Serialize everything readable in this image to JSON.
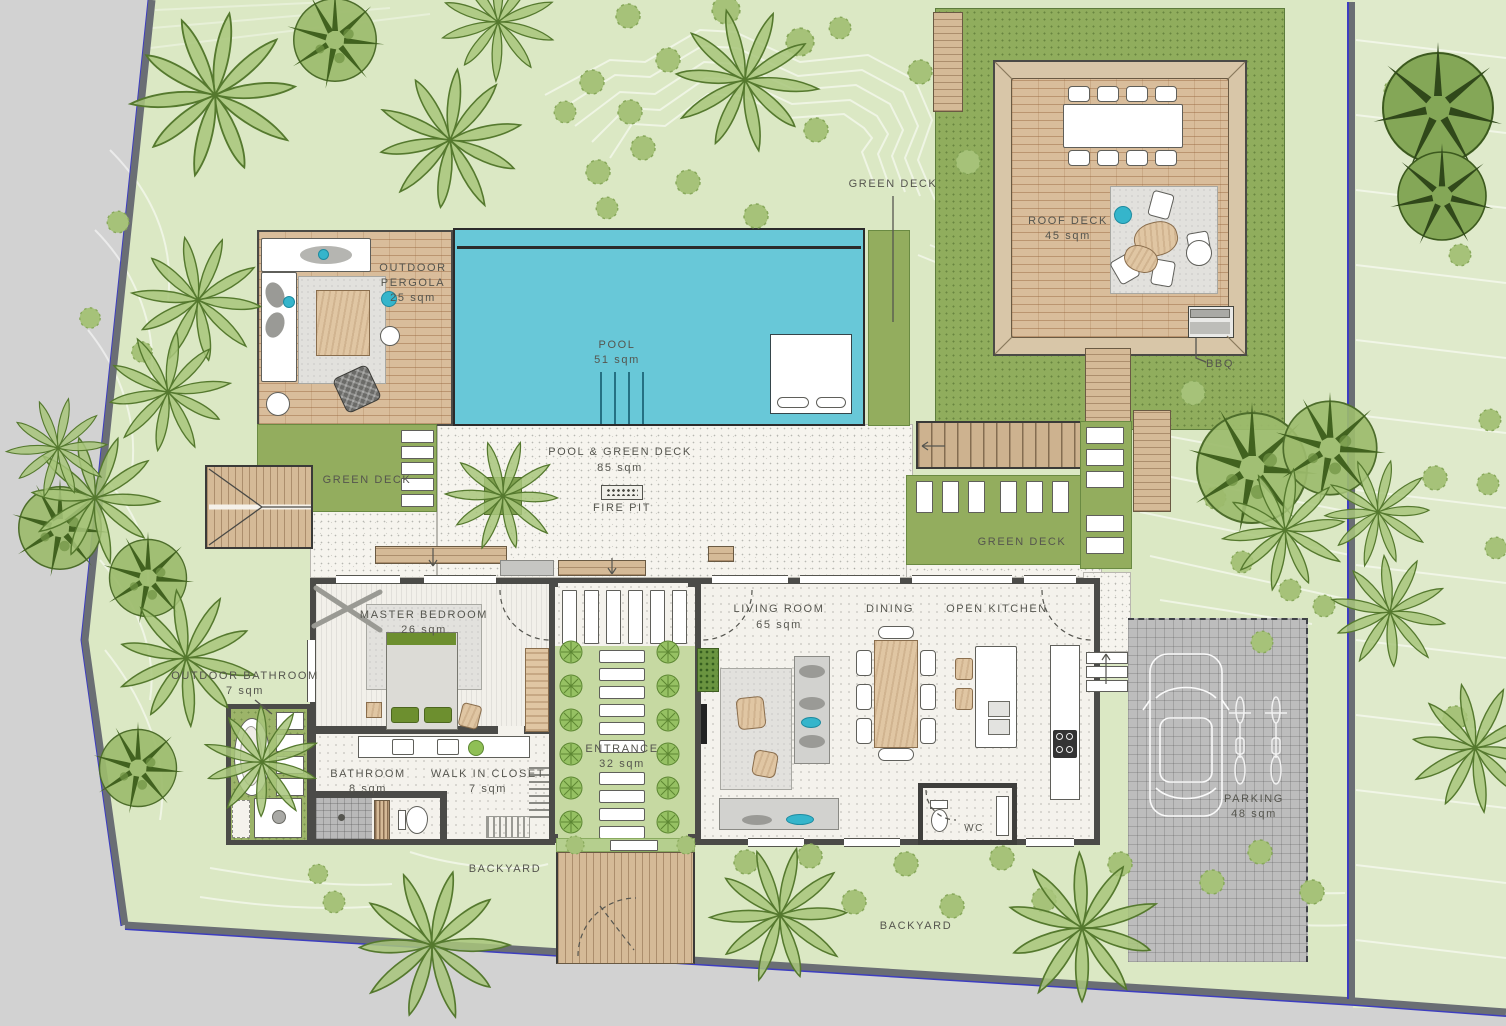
{
  "title": "Villa landscape floor plan",
  "areas": {
    "green_deck_top": {
      "name": "GREEN DECK"
    },
    "roof_deck": {
      "name": "ROOF DECK",
      "area": "45 sqm"
    },
    "bbq": {
      "name": "BBQ"
    },
    "outdoor_pergola": {
      "line1": "OUTDOOR",
      "line2": "PERGOLA",
      "area": "25 sqm"
    },
    "pool": {
      "name": "POOL",
      "area": "51 sqm"
    },
    "pool_green_deck": {
      "name": "POOL & GREEN DECK",
      "area": "85 sqm"
    },
    "fire_pit": {
      "name": "FIRE PIT"
    },
    "green_deck_left": {
      "name": "GREEN DECK"
    },
    "green_deck_right": {
      "name": "GREEN DECK"
    },
    "master_bedroom": {
      "name": "MASTER BEDROOM",
      "area": "26 sqm"
    },
    "outdoor_bathroom": {
      "name": "OUTDOOR BATHROOM",
      "area": "7 sqm"
    },
    "bathroom": {
      "name": "BATHROOM",
      "area": "8 sqm"
    },
    "walk_in_closet": {
      "name": "WALK IN CLOSET",
      "area": "7 sqm"
    },
    "entrance": {
      "name": "ENTRANCE",
      "area": "32 sqm"
    },
    "living_room": {
      "name": "LIVING ROOM",
      "area": "65 sqm"
    },
    "dining": {
      "name": "DINING"
    },
    "open_kitchen": {
      "name": "OPEN KITCHEN"
    },
    "wc": {
      "name": "WC"
    },
    "parking": {
      "name": "PARKING",
      "area": "48 sqm"
    },
    "backyard_left": {
      "name": "BACKYARD"
    },
    "backyard_right": {
      "name": "BACKYARD"
    }
  },
  "colors": {
    "pool": "#68c8d8",
    "lawn": "#dbe8c4",
    "green_deck": "#93ad5e",
    "wood_deck": "#d9bd9b",
    "accent_teal": "#35b5cb",
    "outside": "#d2d2d2"
  }
}
